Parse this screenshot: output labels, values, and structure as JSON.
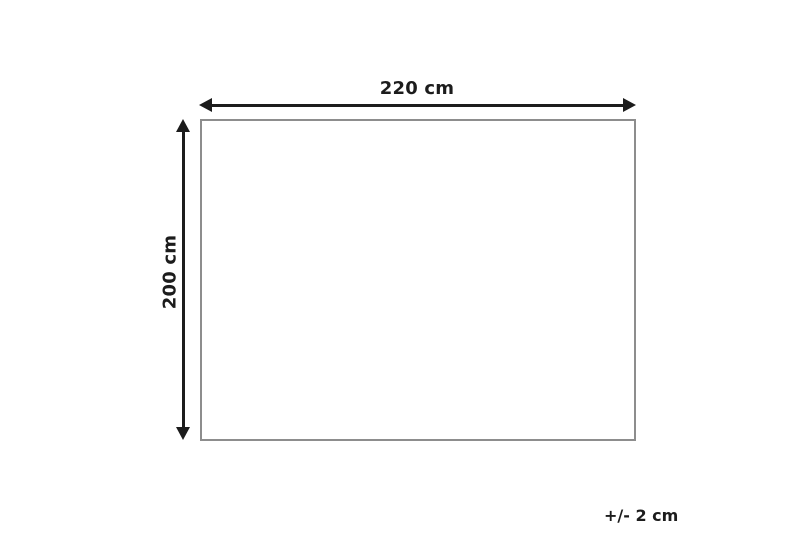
{
  "diagram": {
    "width_label": "220 cm",
    "height_label": "200 cm",
    "tolerance_label": "+/- 2 cm",
    "colors": {
      "background": "#ffffff",
      "arrow": "#1c1c1c",
      "text": "#1c1c1c",
      "rect_border": "#8d8d8d"
    }
  }
}
